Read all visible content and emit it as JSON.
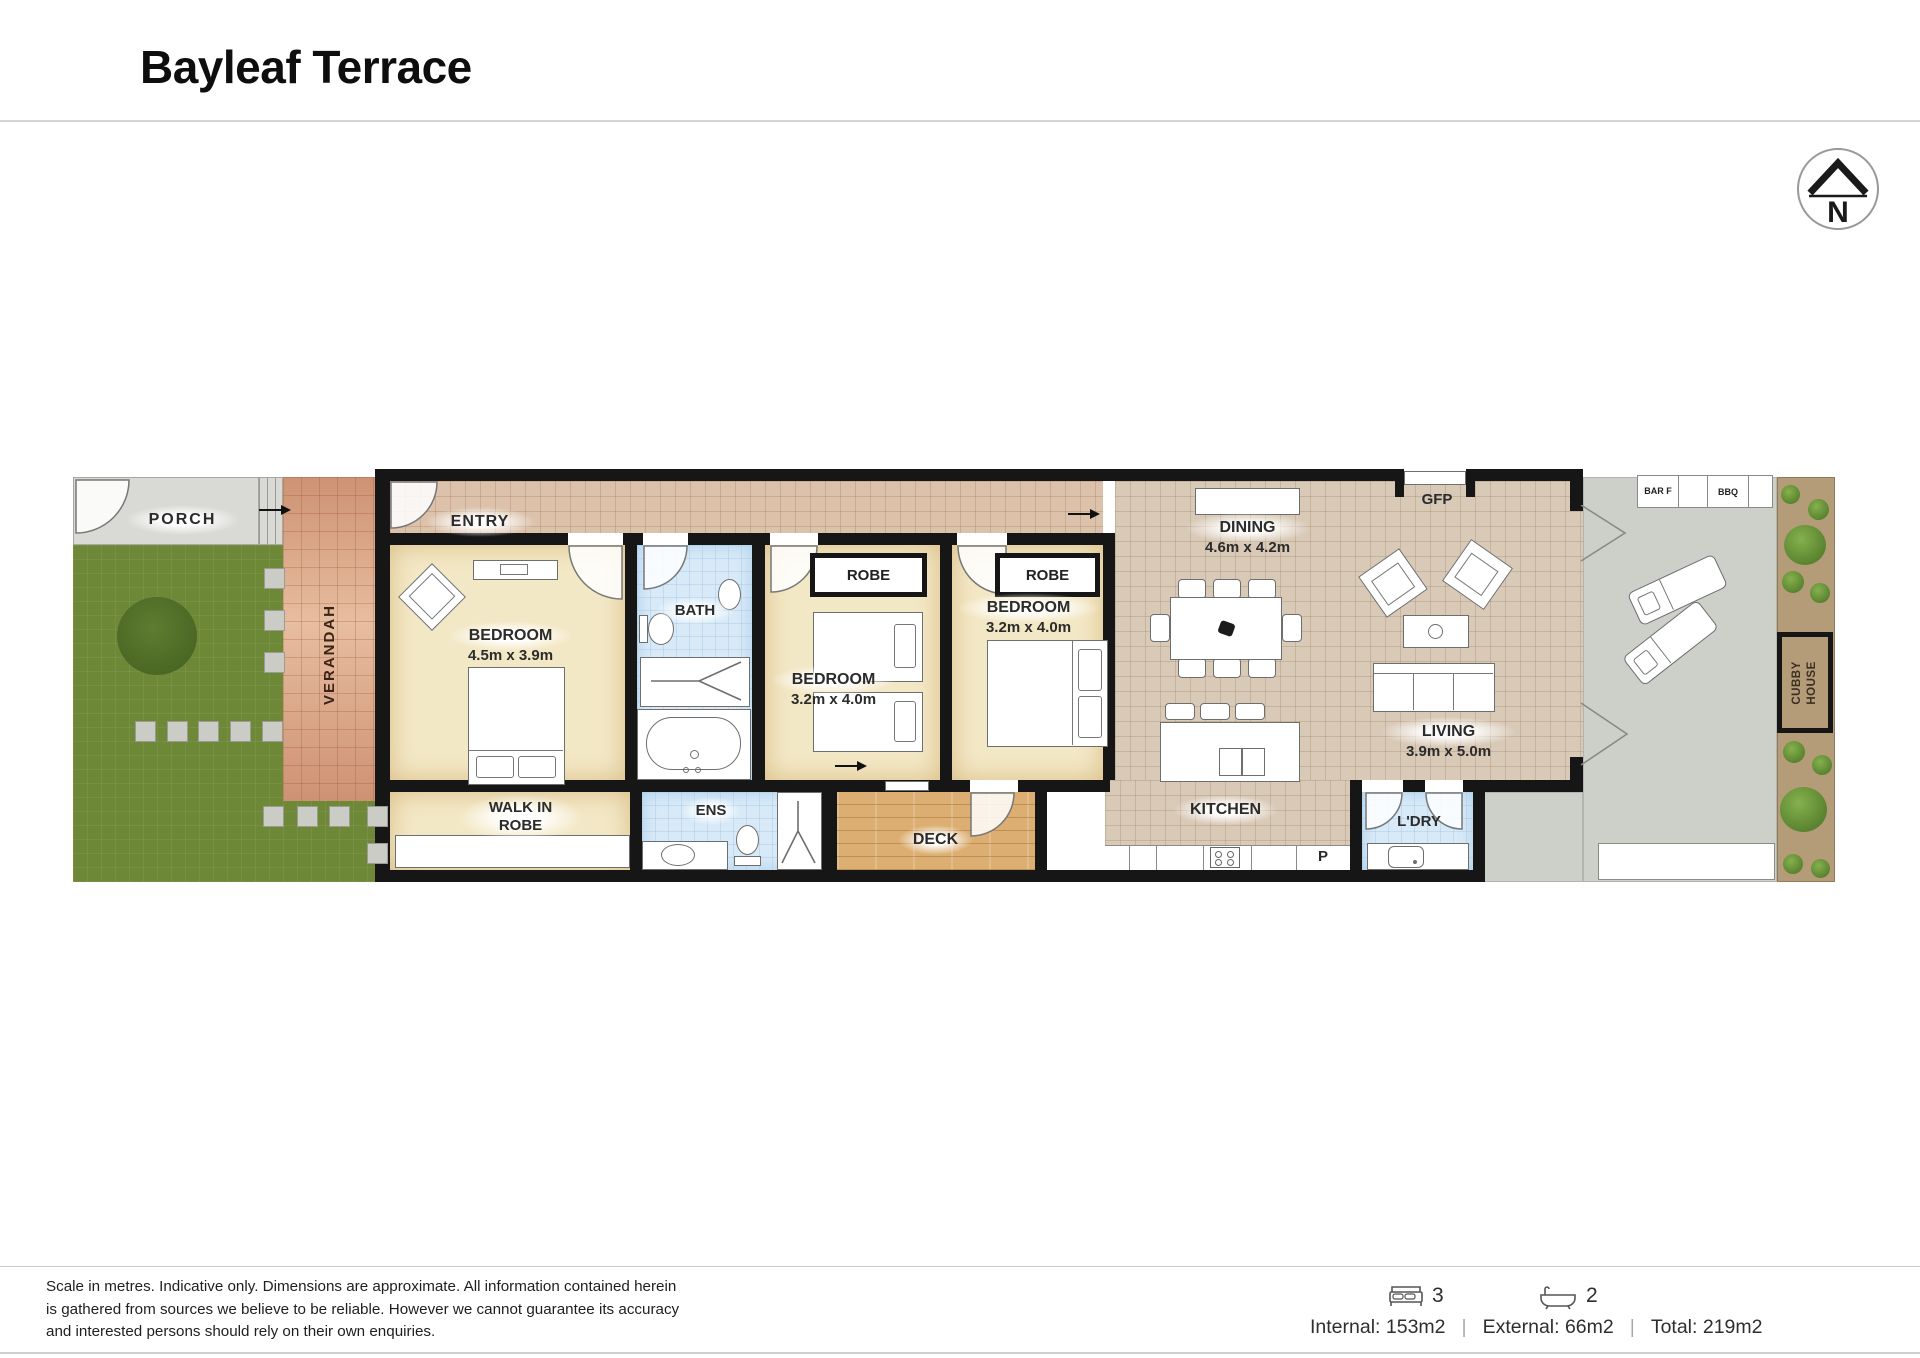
{
  "header": {
    "title": "Bayleaf Terrace"
  },
  "compass": {
    "label": "N"
  },
  "plan": {
    "outdoor": {
      "porch": "PORCH",
      "verandah": "VERANDAH",
      "deck": "DECK",
      "bar_fridge": "BAR F",
      "bbq": "BBQ",
      "cubby_house": "CUBBY HOUSE"
    },
    "rooms": {
      "entry": "ENTRY",
      "bedroom1": {
        "name": "BEDROOM",
        "dims": "4.5m x 3.9m"
      },
      "bath": "BATH",
      "bedroom2": {
        "name": "BEDROOM",
        "dims": "3.2m x 4.0m"
      },
      "robe2": "ROBE",
      "bedroom3": {
        "name": "BEDROOM",
        "dims": "3.2m x 4.0m"
      },
      "robe3": "ROBE",
      "walk_in_robe": "WALK IN ROBE",
      "ensuite": "ENS",
      "dining": {
        "name": "DINING",
        "dims": "4.6m x 4.2m"
      },
      "gfp": "GFP",
      "kitchen": "KITCHEN",
      "pantry": "P",
      "laundry": "L'DRY",
      "living": {
        "name": "LIVING",
        "dims": "3.9m x 5.0m"
      }
    }
  },
  "footer": {
    "disclaimer": "Scale in metres. Indicative only. Dimensions are approximate. All information contained herein is gathered from sources we believe to be reliable. However we cannot guarantee its accuracy and interested persons should rely on their own enquiries.",
    "bed_count": "3",
    "bath_count": "2",
    "internal": "Internal: 153m2",
    "external": "External: 66m2",
    "total": "Total: 219m2",
    "separator": "|"
  },
  "icons": {
    "compass": "north-compass",
    "bed": "bed-icon",
    "bath": "bathtub-icon"
  },
  "colors": {
    "wall": "#161616",
    "lawn": "#6d8836",
    "verandah_brick": "#d09a7c",
    "floor_tile": "#d9cab8",
    "entry_tile": "#dcc2ab",
    "room_cream": "#f3e8c6",
    "wet_area_blue": "#d8eaf8",
    "deck_timber": "#dcae72",
    "patio_concrete": "#cdd0c9",
    "garden_bed": "#b59c79"
  }
}
